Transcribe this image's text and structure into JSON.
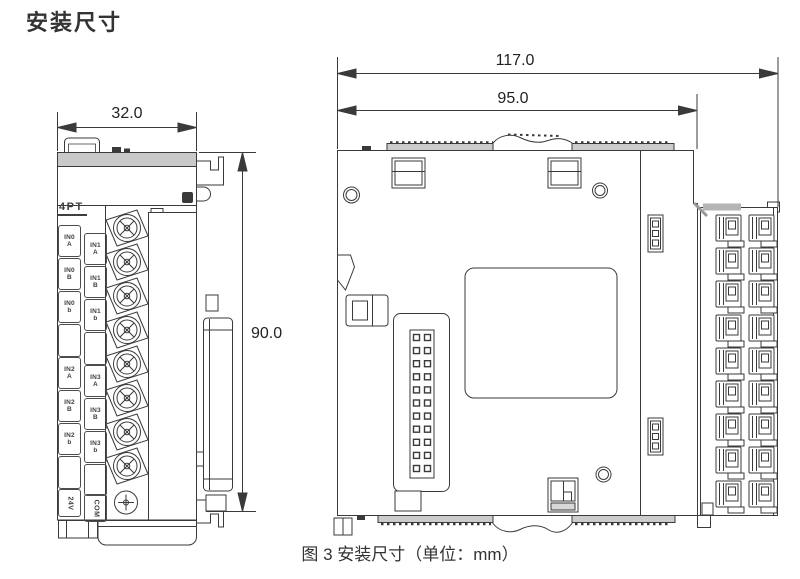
{
  "page": {
    "title": "安装尺寸",
    "caption": "图 3 安装尺寸（单位：mm）"
  },
  "dimensions": {
    "front_width_mm": "32.0",
    "front_height_mm": "90.0",
    "side_total_depth_mm": "117.0",
    "side_body_depth_mm": "95.0"
  },
  "front_view": {
    "model_label": "4PT",
    "left_terminal_labels": [
      "IN0\nA",
      "IN0\nB",
      "IN0\nb",
      "",
      "IN2\nA",
      "IN2\nB",
      "IN2\nb",
      "",
      "24V"
    ],
    "right_terminal_labels": [
      "IN1\nA",
      "IN1\nB",
      "IN1\nb",
      "",
      "IN3\nA",
      "IN3\nB",
      "IN3\nb",
      "",
      "COM"
    ]
  },
  "colors": {
    "line": "#3a3a3a",
    "panel_gray": "#c9c9c9",
    "led_dark": "#3a3a3a"
  }
}
